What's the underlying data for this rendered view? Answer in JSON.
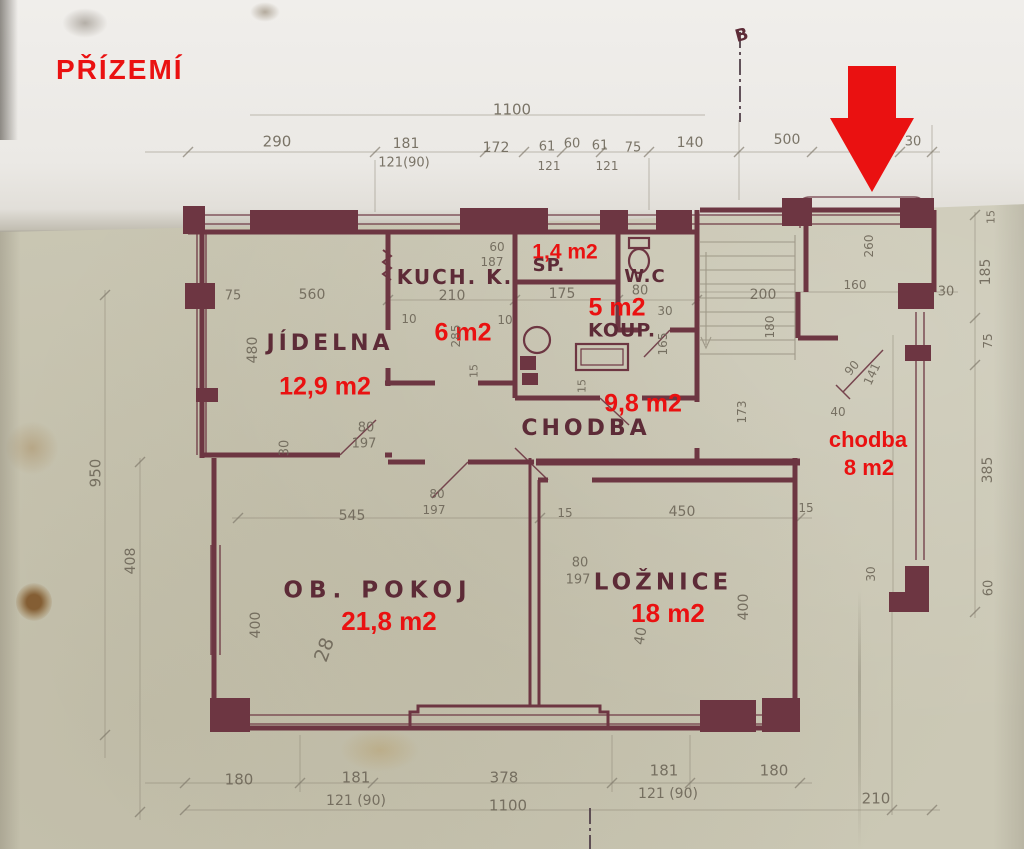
{
  "title": {
    "text": "PŘÍZEMÍ"
  },
  "colors": {
    "annotation_red": "#ea1111",
    "wall_maroon": "#6d3642",
    "pencil_grey": "#6b6456",
    "paper_main": "#cbc8b5",
    "paper_fold": "#efedea"
  },
  "rooms": [
    {
      "name": "JÍDELNA",
      "area": "12,9 m2"
    },
    {
      "name": "KUCH. K.",
      "area": "6 m2"
    },
    {
      "name": "SP.",
      "area": "1,4 m2"
    },
    {
      "name": "W.C",
      "area": ""
    },
    {
      "name": "KOUP.",
      "area": "5 m2"
    },
    {
      "name": "CHODBA",
      "area": "9,8 m2"
    },
    {
      "name": "OB. POKOJ",
      "area": "21,8 m2"
    },
    {
      "name": "LOŽNICE",
      "area": "18 m2"
    },
    {
      "name": "chodba",
      "area": "8 m2"
    }
  ],
  "plan": {
    "labels": [
      {
        "t": "1,4 m2",
        "x": 565,
        "y": 252,
        "s": 21,
        "c": "red"
      },
      {
        "t": "5 m2",
        "x": 617,
        "y": 308,
        "s": 25,
        "c": "red"
      },
      {
        "t": "6 m2",
        "x": 463,
        "y": 333,
        "s": 25,
        "c": "red"
      },
      {
        "t": "12,9 m2",
        "x": 325,
        "y": 387,
        "s": 25,
        "c": "red"
      },
      {
        "t": "9,8 m2",
        "x": 643,
        "y": 404,
        "s": 25,
        "c": "red"
      },
      {
        "t": "chodba",
        "x": 868,
        "y": 440,
        "s": 22,
        "c": "red"
      },
      {
        "t": "8 m2",
        "x": 869,
        "y": 468,
        "s": 22,
        "c": "red"
      },
      {
        "t": "21,8 m2",
        "x": 389,
        "y": 621,
        "s": 26,
        "c": "red"
      },
      {
        "t": "18 m2",
        "x": 668,
        "y": 613,
        "s": 26,
        "c": "red"
      },
      {
        "t": "KUCH. K.",
        "x": 455,
        "y": 277,
        "s": 20,
        "ls": 2,
        "c": "room"
      },
      {
        "t": "SP.",
        "x": 549,
        "y": 266,
        "s": 18,
        "ls": 1,
        "c": "room"
      },
      {
        "t": "W.C",
        "x": 645,
        "y": 277,
        "s": 18,
        "ls": 1,
        "c": "room"
      },
      {
        "t": "KOUP.",
        "x": 622,
        "y": 331,
        "s": 19,
        "ls": 1,
        "c": "room"
      },
      {
        "t": "JÍDELNA",
        "x": 330,
        "y": 344,
        "s": 22,
        "ls": 4,
        "c": "room"
      },
      {
        "t": "CHODBA",
        "x": 586,
        "y": 429,
        "s": 22,
        "ls": 4,
        "c": "room"
      },
      {
        "t": "OB. POKOJ",
        "x": 378,
        "y": 591,
        "s": 23,
        "ls": 6,
        "c": "room"
      },
      {
        "t": "LOŽNICE",
        "x": 663,
        "y": 583,
        "s": 23,
        "ls": 4,
        "c": "room"
      },
      {
        "t": "B",
        "x": 742,
        "y": 36,
        "s": 17,
        "r": -15,
        "c": "room"
      },
      {
        "t": "1100",
        "x": 512,
        "y": 110,
        "s": 15,
        "c": "pencil"
      },
      {
        "t": "290",
        "x": 277,
        "y": 142,
        "s": 15,
        "c": "pencil"
      },
      {
        "t": "181",
        "x": 406,
        "y": 144,
        "s": 14,
        "c": "pencil"
      },
      {
        "t": "121(90)",
        "x": 404,
        "y": 163,
        "s": 13,
        "c": "pencil"
      },
      {
        "t": "172",
        "x": 496,
        "y": 148,
        "s": 14,
        "c": "pencil"
      },
      {
        "t": "61",
        "x": 547,
        "y": 147,
        "s": 13,
        "c": "pencil"
      },
      {
        "t": "60",
        "x": 572,
        "y": 144,
        "s": 13,
        "c": "pencil"
      },
      {
        "t": "61",
        "x": 600,
        "y": 146,
        "s": 13,
        "c": "pencil"
      },
      {
        "t": "75",
        "x": 633,
        "y": 148,
        "s": 13,
        "c": "pencil"
      },
      {
        "t": "121",
        "x": 549,
        "y": 166,
        "s": 12,
        "c": "pencil"
      },
      {
        "t": "121",
        "x": 607,
        "y": 166,
        "s": 12,
        "c": "pencil"
      },
      {
        "t": "140",
        "x": 690,
        "y": 143,
        "s": 14,
        "c": "pencil"
      },
      {
        "t": "500",
        "x": 787,
        "y": 140,
        "s": 14,
        "c": "pencil"
      },
      {
        "t": "30",
        "x": 913,
        "y": 142,
        "s": 13,
        "c": "pencil"
      },
      {
        "t": "75",
        "x": 233,
        "y": 296,
        "s": 13,
        "c": "pencil"
      },
      {
        "t": "560",
        "x": 312,
        "y": 295,
        "s": 14,
        "c": "pencil"
      },
      {
        "t": "480",
        "x": 253,
        "y": 350,
        "s": 14,
        "r": -90,
        "c": "pencil"
      },
      {
        "t": "30",
        "x": 285,
        "y": 448,
        "s": 13,
        "r": -90,
        "c": "pencil"
      },
      {
        "t": "950",
        "x": 96,
        "y": 473,
        "s": 15,
        "r": -90,
        "c": "pencil"
      },
      {
        "t": "408",
        "x": 131,
        "y": 561,
        "s": 14,
        "r": -90,
        "c": "pencil"
      },
      {
        "t": "60",
        "x": 497,
        "y": 247,
        "s": 12,
        "c": "pencil"
      },
      {
        "t": "187",
        "x": 492,
        "y": 262,
        "s": 12,
        "c": "pencil"
      },
      {
        "t": "210",
        "x": 452,
        "y": 296,
        "s": 14,
        "c": "pencil"
      },
      {
        "t": "10",
        "x": 409,
        "y": 319,
        "s": 12,
        "c": "pencil"
      },
      {
        "t": "10",
        "x": 505,
        "y": 320,
        "s": 12,
        "c": "pencil"
      },
      {
        "t": "285",
        "x": 456,
        "y": 336,
        "s": 12,
        "r": -90,
        "c": "pencil"
      },
      {
        "t": "15",
        "x": 474,
        "y": 371,
        "s": 11,
        "r": -90,
        "c": "pencil"
      },
      {
        "t": "175",
        "x": 562,
        "y": 294,
        "s": 14,
        "c": "pencil"
      },
      {
        "t": "80",
        "x": 640,
        "y": 291,
        "s": 13,
        "c": "pencil"
      },
      {
        "t": "30",
        "x": 665,
        "y": 311,
        "s": 12,
        "c": "pencil"
      },
      {
        "t": "165",
        "x": 663,
        "y": 344,
        "s": 12,
        "r": -90,
        "c": "pencil"
      },
      {
        "t": "80",
        "x": 366,
        "y": 428,
        "s": 13,
        "c": "pencil"
      },
      {
        "t": "197",
        "x": 364,
        "y": 444,
        "s": 13,
        "c": "pencil"
      },
      {
        "t": "80",
        "x": 437,
        "y": 494,
        "s": 12,
        "c": "pencil"
      },
      {
        "t": "197",
        "x": 434,
        "y": 510,
        "s": 12,
        "c": "pencil"
      },
      {
        "t": "80",
        "x": 580,
        "y": 563,
        "s": 13,
        "c": "pencil"
      },
      {
        "t": "197",
        "x": 578,
        "y": 580,
        "s": 13,
        "c": "pencil"
      },
      {
        "t": "200",
        "x": 763,
        "y": 295,
        "s": 14,
        "c": "pencil"
      },
      {
        "t": "180",
        "x": 770,
        "y": 327,
        "s": 12,
        "r": -90,
        "c": "pencil"
      },
      {
        "t": "260",
        "x": 869,
        "y": 246,
        "s": 12,
        "r": -90,
        "c": "pencil"
      },
      {
        "t": "160",
        "x": 855,
        "y": 285,
        "s": 12,
        "c": "pencil"
      },
      {
        "t": "30",
        "x": 946,
        "y": 292,
        "s": 13,
        "c": "pencil"
      },
      {
        "t": "90",
        "x": 852,
        "y": 368,
        "s": 12,
        "r": -50,
        "c": "pencil"
      },
      {
        "t": "141",
        "x": 872,
        "y": 374,
        "s": 12,
        "r": -65,
        "c": "pencil"
      },
      {
        "t": "40",
        "x": 838,
        "y": 412,
        "s": 12,
        "c": "pencil"
      },
      {
        "t": "173",
        "x": 742,
        "y": 412,
        "s": 12,
        "r": -90,
        "c": "pencil"
      },
      {
        "t": "15",
        "x": 582,
        "y": 386,
        "s": 11,
        "r": -90,
        "c": "pencil"
      },
      {
        "t": "15",
        "x": 991,
        "y": 217,
        "s": 11,
        "r": -90,
        "c": "pencil"
      },
      {
        "t": "185",
        "x": 986,
        "y": 272,
        "s": 14,
        "r": -90,
        "c": "pencil"
      },
      {
        "t": "75",
        "x": 988,
        "y": 341,
        "s": 12,
        "r": -90,
        "c": "pencil"
      },
      {
        "t": "385",
        "x": 988,
        "y": 470,
        "s": 14,
        "r": -90,
        "c": "pencil"
      },
      {
        "t": "30",
        "x": 871,
        "y": 574,
        "s": 12,
        "r": -90,
        "c": "pencil"
      },
      {
        "t": "60",
        "x": 989,
        "y": 588,
        "s": 13,
        "r": -90,
        "c": "pencil"
      },
      {
        "t": "545",
        "x": 352,
        "y": 516,
        "s": 14,
        "c": "pencil"
      },
      {
        "t": "15",
        "x": 565,
        "y": 513,
        "s": 12,
        "c": "pencil"
      },
      {
        "t": "450",
        "x": 682,
        "y": 512,
        "s": 14,
        "c": "pencil"
      },
      {
        "t": "15",
        "x": 806,
        "y": 508,
        "s": 12,
        "c": "pencil"
      },
      {
        "t": "400",
        "x": 256,
        "y": 625,
        "s": 14,
        "r": -90,
        "c": "pencil"
      },
      {
        "t": "28",
        "x": 325,
        "y": 650,
        "s": 19,
        "r": -70,
        "c": "pencil"
      },
      {
        "t": "400",
        "x": 744,
        "y": 607,
        "s": 14,
        "r": -90,
        "c": "pencil"
      },
      {
        "t": "40",
        "x": 641,
        "y": 636,
        "s": 14,
        "r": -80,
        "c": "pencil"
      },
      {
        "t": "180",
        "x": 239,
        "y": 780,
        "s": 15,
        "c": "pencil"
      },
      {
        "t": "181",
        "x": 356,
        "y": 778,
        "s": 15,
        "c": "pencil"
      },
      {
        "t": "121 (90)",
        "x": 356,
        "y": 801,
        "s": 14,
        "c": "pencil"
      },
      {
        "t": "378",
        "x": 504,
        "y": 778,
        "s": 15,
        "c": "pencil"
      },
      {
        "t": "1100",
        "x": 508,
        "y": 806,
        "s": 15,
        "c": "pencil"
      },
      {
        "t": "181",
        "x": 664,
        "y": 771,
        "s": 15,
        "c": "pencil"
      },
      {
        "t": "121 (90)",
        "x": 668,
        "y": 794,
        "s": 14,
        "c": "pencil"
      },
      {
        "t": "180",
        "x": 774,
        "y": 771,
        "s": 15,
        "c": "pencil"
      },
      {
        "t": "210",
        "x": 876,
        "y": 799,
        "s": 15,
        "c": "pencil"
      }
    ]
  }
}
